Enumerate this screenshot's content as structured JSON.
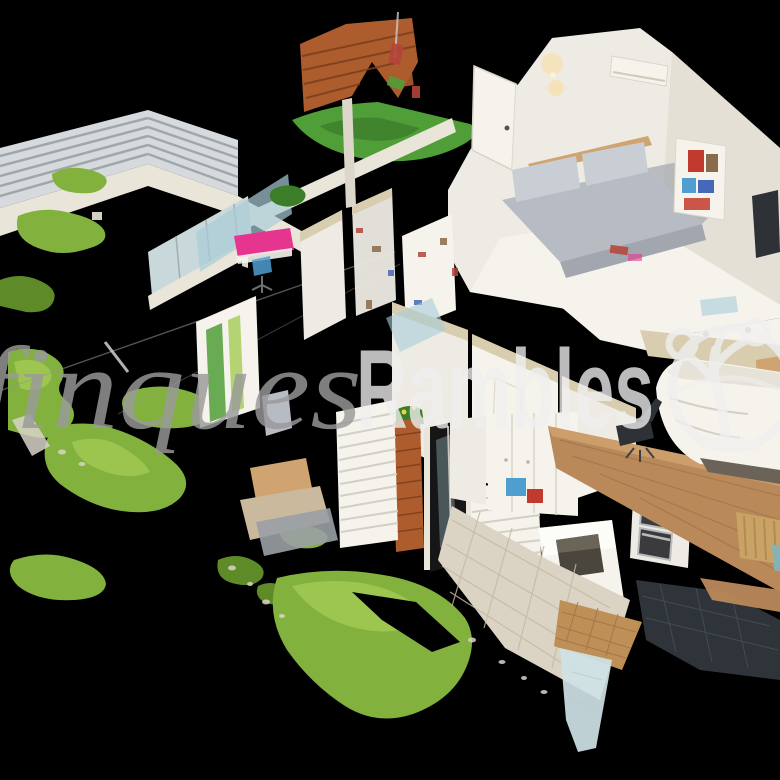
{
  "viewer": {
    "type": "3d-dollhouse-scan",
    "description": "Cutaway dollhouse view of a duplex apartment with terrace garden (photogrammetry point-cloud render on black background)",
    "background": "#000000"
  },
  "watermark": {
    "brand_serif": "finques",
    "brand_bold": "Rambles",
    "logo": "tree-in-circle-icon"
  },
  "scene": {
    "areas": [
      "terrace-garden",
      "living-room",
      "home-office",
      "kitchen",
      "bathroom",
      "bedroom",
      "rooftop-terrace"
    ],
    "features": [
      "artificial-grass-patches",
      "slatted-fence",
      "brick-wall-fragment",
      "brick-pillar",
      "gray-sofa",
      "pink-desk",
      "oven-and-microwave-column",
      "white-bed",
      "wood-floor-slab",
      "tiled-floors",
      "louver-panels",
      "air-conditioner",
      "colorful-bookshelf"
    ]
  },
  "colors": {
    "bg": "#000000",
    "grass": "#83b13e",
    "grassDark": "#5e8a28",
    "grassBright": "#a4cc55",
    "turf": "#4f9e38",
    "turfDark": "#3c7d2a",
    "wallWhite": "#edebe3",
    "wallCream": "#f5f3ec",
    "wallShade": "#dcd7ca",
    "beigeTop": "#d9cdb0",
    "woodFloor": "#b9895a",
    "woodLight": "#cfa470",
    "sofa": "#b7bbc3",
    "sofaLight": "#c9cdd4",
    "sofaDark": "#a2a6af",
    "brick": "#ad5c2e",
    "brickLine": "#7c3e1c",
    "pinkDesk": "#e5358f",
    "glassBlue": "#a9cdd9",
    "glassPale": "#c9d8da",
    "tileLight": "#dbd3c4",
    "tileSeam": "#c3b9a6",
    "terracotta": "#bf8f58",
    "terraSeam": "#9f7443",
    "tileDark": "#2f333a",
    "tileDarkSeam": "#474e58",
    "fence": "#d6dadd",
    "fenceLine": "#9aa2a8",
    "ledge": "#e9e5d9",
    "applianceDark": "#3b3b3d",
    "steel": "#b9babc",
    "blueItem": "#4f9ed0",
    "redItem": "#c23a2e",
    "radiator": "#c9a266",
    "wmGray": "#9a9a9a",
    "wmWhite": "#f0f0f0",
    "glow": "#ffd98f",
    "noiseRed": "#b5443a",
    "noiseBlue": "#4668b8",
    "noiseBrown": "#8a6a4a",
    "floorBeige": "#cbb99e",
    "grayFloor": "#9aa0a4",
    "darkChair": "#2e3135"
  }
}
